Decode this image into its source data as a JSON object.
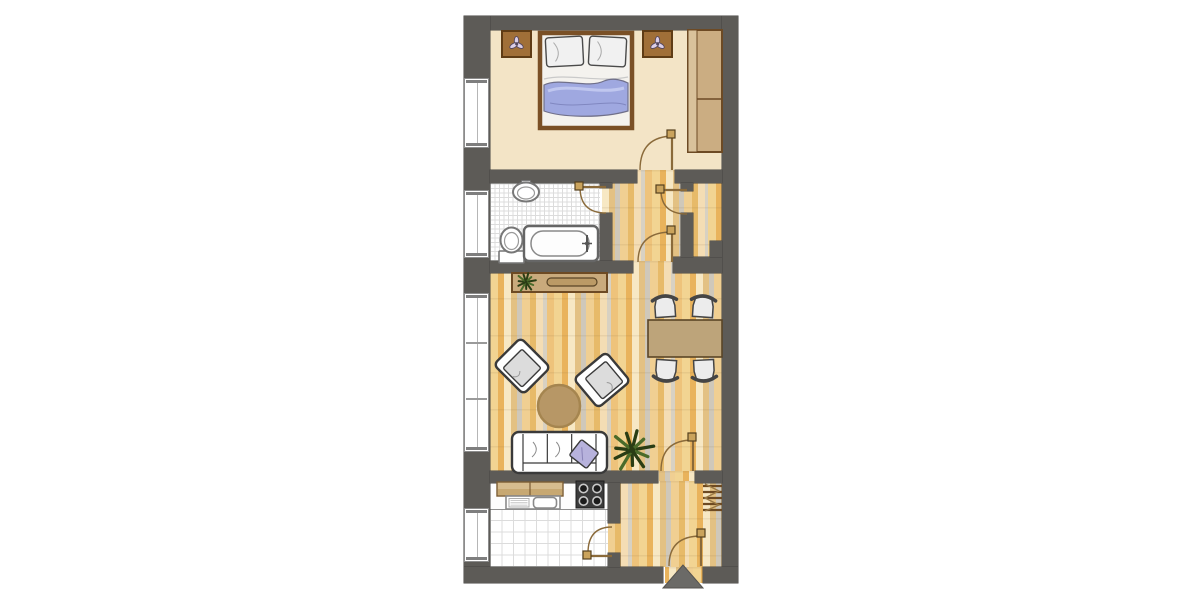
{
  "page": {
    "title": "Apartment Floor Plan",
    "type": "architectural-floor-plan",
    "canvas": {
      "w": 1200,
      "h": 600
    }
  },
  "palette": {
    "wall": "#5d5b57",
    "arrow": "#6b6a67",
    "bedroom_floor": "#f3e4c6",
    "wood_light": "#f2d492",
    "wood_orange": "#e9b35c",
    "wood_cream": "#f7e8c4",
    "wood_gray": "#cfc8ba",
    "furniture_tan": "#c9aa7c",
    "furniture_tan_dark": "#bb9a66",
    "cabinet_tan": "#d6bc8e",
    "brown_line": "#6d4a24",
    "door_line": "#8a6a3a",
    "door_square": "#caa35c",
    "bed_frame": "#7a5026",
    "blanket_blue": "#9fa8e0",
    "pillow_lilac": "#b7b2dc",
    "fixture_stroke": "#777777",
    "stove_dark": "#3b3b3b",
    "plant_green": "#2a3d14",
    "plant_green_light": "#4a6b2a",
    "seat_gray": "#dcdcdc",
    "outline_dark": "#3a3a3a"
  },
  "rooms": [
    {
      "name": "bedroom"
    },
    {
      "name": "bathroom"
    },
    {
      "name": "hall"
    },
    {
      "name": "storage-room"
    },
    {
      "name": "living-dining-room"
    },
    {
      "name": "kitchen"
    },
    {
      "name": "entrance-hall"
    }
  ],
  "floors": [
    {
      "name": "bedroom-floor",
      "kind": "beige",
      "x": 490,
      "y": 30,
      "w": 232,
      "h": 140
    },
    {
      "name": "bathroom-floor",
      "kind": "tile",
      "x": 490,
      "y": 183,
      "w": 110,
      "h": 78,
      "pitch": 4.5
    },
    {
      "name": "hall-floor",
      "kind": "wood",
      "x": 602,
      "y": 170,
      "w": 120,
      "h": 103,
      "off": -14
    },
    {
      "name": "living-room-floor",
      "kind": "wood",
      "x": 490,
      "y": 261,
      "w": 232,
      "h": 210,
      "off": 0
    },
    {
      "name": "living-door-threshold",
      "kind": "wood",
      "x": 658,
      "y": 471,
      "w": 37,
      "h": 12,
      "off": -20
    },
    {
      "name": "kitchen-counter-strip",
      "kind": "plain",
      "x": 490,
      "y": 481,
      "w": 118,
      "h": 29
    },
    {
      "name": "kitchen-floor",
      "kind": "tile",
      "x": 490,
      "y": 510,
      "w": 118,
      "h": 57,
      "pitch": 11.5
    },
    {
      "name": "kitchen-threshold",
      "kind": "wood",
      "x": 608,
      "y": 523,
      "w": 12,
      "h": 30,
      "off": -40
    },
    {
      "name": "entrance-hall-floor",
      "kind": "wood",
      "x": 608,
      "y": 481,
      "w": 114,
      "h": 86,
      "off": -33
    },
    {
      "name": "entrance-threshold",
      "kind": "wood",
      "x": 665,
      "y": 567,
      "w": 38,
      "h": 16,
      "off": -48
    }
  ],
  "walls": [
    {
      "name": "wall-top",
      "x": 464,
      "y": 16,
      "w": 274,
      "h": 14
    },
    {
      "name": "wall-left",
      "x": 464,
      "y": 16,
      "w": 26,
      "h": 567
    },
    {
      "name": "wall-right",
      "x": 722,
      "y": 16,
      "w": 16,
      "h": 567
    },
    {
      "name": "wall-bottom-left",
      "x": 464,
      "y": 567,
      "w": 199,
      "h": 16
    },
    {
      "name": "wall-bottom-right",
      "x": 703,
      "y": 567,
      "w": 35,
      "h": 16
    },
    {
      "name": "wall-bedroom-divider-left",
      "x": 490,
      "y": 170,
      "w": 147,
      "h": 13
    },
    {
      "name": "wall-bedroom-divider-right",
      "x": 675,
      "y": 170,
      "w": 47,
      "h": 13
    },
    {
      "name": "wall-bathroom-stub",
      "x": 600,
      "y": 183,
      "w": 12,
      "h": 5
    },
    {
      "name": "wall-bathroom-right",
      "x": 600,
      "y": 213,
      "w": 12,
      "h": 48
    },
    {
      "name": "wall-bathroom-bottom",
      "x": 490,
      "y": 261,
      "w": 143,
      "h": 12
    },
    {
      "name": "wall-hall-bottom-right",
      "x": 673,
      "y": 257,
      "w": 49,
      "h": 16
    },
    {
      "name": "wall-storage-stub",
      "x": 681,
      "y": 183,
      "w": 12,
      "h": 8
    },
    {
      "name": "wall-storage-left",
      "x": 681,
      "y": 213,
      "w": 12,
      "h": 44
    },
    {
      "name": "wall-storage-notch",
      "x": 710,
      "y": 241,
      "w": 12,
      "h": 16
    },
    {
      "name": "wall-living-bottom-left",
      "x": 490,
      "y": 471,
      "w": 168,
      "h": 12
    },
    {
      "name": "wall-living-bottom-right",
      "x": 695,
      "y": 471,
      "w": 27,
      "h": 12
    },
    {
      "name": "wall-kitchen-right-top",
      "x": 608,
      "y": 483,
      "w": 12,
      "h": 40
    },
    {
      "name": "wall-kitchen-right-bottom",
      "x": 608,
      "y": 553,
      "w": 12,
      "h": 14
    }
  ],
  "windows": [
    {
      "name": "bedroom-window",
      "x": 464,
      "y": 78,
      "w": 25,
      "h": 70,
      "ticks": []
    },
    {
      "name": "bathroom-window",
      "x": 464,
      "y": 190,
      "w": 25,
      "h": 68,
      "ticks": []
    },
    {
      "name": "living-room-window",
      "x": 464,
      "y": 293,
      "w": 25,
      "h": 159,
      "ticks": [
        48,
        104
      ]
    },
    {
      "name": "kitchen-window",
      "x": 464,
      "y": 508,
      "w": 25,
      "h": 54,
      "ticks": []
    }
  ],
  "doors": [
    {
      "name": "bedroom-door",
      "leaf": [
        672,
        170,
        672,
        137
      ],
      "square": [
        667,
        130
      ],
      "arc": "M674,136 Q640,136 640,170"
    },
    {
      "name": "bathroom-door",
      "leaf": [
        606,
        187,
        580,
        187
      ],
      "square": [
        575,
        182
      ],
      "arc": "M580,187 Q580,213 606,213"
    },
    {
      "name": "storage-door",
      "leaf": [
        687,
        190,
        661,
        190
      ],
      "square": [
        656,
        185
      ],
      "arc": "M661,190 Q661,214 687,214"
    },
    {
      "name": "hall-door",
      "leaf": [
        672,
        262,
        672,
        233
      ],
      "square": [
        667,
        226
      ],
      "arc": "M672,232 Q638,232 638,262"
    },
    {
      "name": "living-room-door",
      "leaf": [
        693,
        471,
        693,
        440
      ],
      "square": [
        688,
        433
      ],
      "arc": "M693,440 Q661,440 661,471"
    },
    {
      "name": "kitchen-door",
      "leaf": [
        612,
        556,
        588,
        556
      ],
      "square": [
        583,
        551
      ],
      "arc": "M588,553 Q588,527 612,527"
    },
    {
      "name": "entrance-door",
      "leaf": [
        701,
        566,
        701,
        536
      ],
      "square": [
        697,
        529
      ],
      "arc": "M701,536 Q669,536 669,566"
    }
  ],
  "furniture": [
    {
      "name": "double-bed",
      "type": "bed",
      "x": 540,
      "y": 33,
      "w": 92,
      "h": 95
    },
    {
      "name": "nightstand-left",
      "type": "nightstand",
      "x": 502,
      "y": 31,
      "w": 29,
      "h": 26
    },
    {
      "name": "nightstand-right",
      "type": "nightstand",
      "x": 643,
      "y": 31,
      "w": 29,
      "h": 26
    },
    {
      "name": "wardrobe",
      "type": "wardrobe",
      "x": 688,
      "y": 30,
      "w": 34,
      "h": 122
    },
    {
      "name": "bathroom-sink",
      "type": "sink",
      "cx": 526,
      "cy": 192
    },
    {
      "name": "toilet",
      "type": "toilet",
      "x": 499,
      "y": 227
    },
    {
      "name": "bathtub",
      "type": "bathtub",
      "x": 524,
      "y": 226,
      "w": 74,
      "h": 35
    },
    {
      "name": "sideboard",
      "type": "sideboard",
      "x": 512,
      "y": 273,
      "w": 95,
      "h": 19
    },
    {
      "name": "sideboard-plant",
      "type": "plant",
      "cx": 526,
      "cy": 282,
      "r": 10
    },
    {
      "name": "armchair-left",
      "type": "armchair",
      "cx": 522,
      "cy": 366,
      "rot": 45
    },
    {
      "name": "armchair-right",
      "type": "armchair",
      "cx": 602,
      "cy": 380,
      "rot": -40
    },
    {
      "name": "coffee-table",
      "type": "round-table",
      "cx": 559,
      "cy": 406,
      "r": 21
    },
    {
      "name": "sofa",
      "type": "sofa",
      "x": 512,
      "y": 432,
      "w": 95,
      "h": 41
    },
    {
      "name": "floor-plant",
      "type": "plant",
      "cx": 632,
      "cy": 450,
      "r": 22
    },
    {
      "name": "dining-table",
      "type": "dining-table",
      "x": 648,
      "y": 320,
      "w": 74,
      "h": 37
    },
    {
      "name": "dining-chair-top-left",
      "type": "dining-chair",
      "cx": 665,
      "cy": 308,
      "rot": -4
    },
    {
      "name": "dining-chair-top-right",
      "type": "dining-chair",
      "cx": 703,
      "cy": 308,
      "rot": 4
    },
    {
      "name": "dining-chair-bottom-left",
      "type": "dining-chair",
      "cx": 666,
      "cy": 369,
      "rot": 184
    },
    {
      "name": "dining-chair-bottom-right",
      "type": "dining-chair",
      "cx": 704,
      "cy": 369,
      "rot": 177
    },
    {
      "name": "kitchen-cabinet",
      "type": "cabinet",
      "x": 497,
      "y": 482,
      "w": 66,
      "h": 14
    },
    {
      "name": "kitchen-sink",
      "type": "ksink",
      "x": 506,
      "y": 496,
      "w": 54,
      "h": 13
    },
    {
      "name": "stove",
      "type": "stove",
      "x": 576,
      "y": 481,
      "w": 28,
      "h": 27
    },
    {
      "name": "coat-rack",
      "type": "coatrack",
      "x": 703,
      "y": 484,
      "w": 19,
      "h": 27
    },
    {
      "name": "entrance-arrow",
      "type": "arrow",
      "points": [
        [
          683,
          565
        ],
        [
          663,
          588
        ],
        [
          703,
          588
        ]
      ]
    }
  ]
}
